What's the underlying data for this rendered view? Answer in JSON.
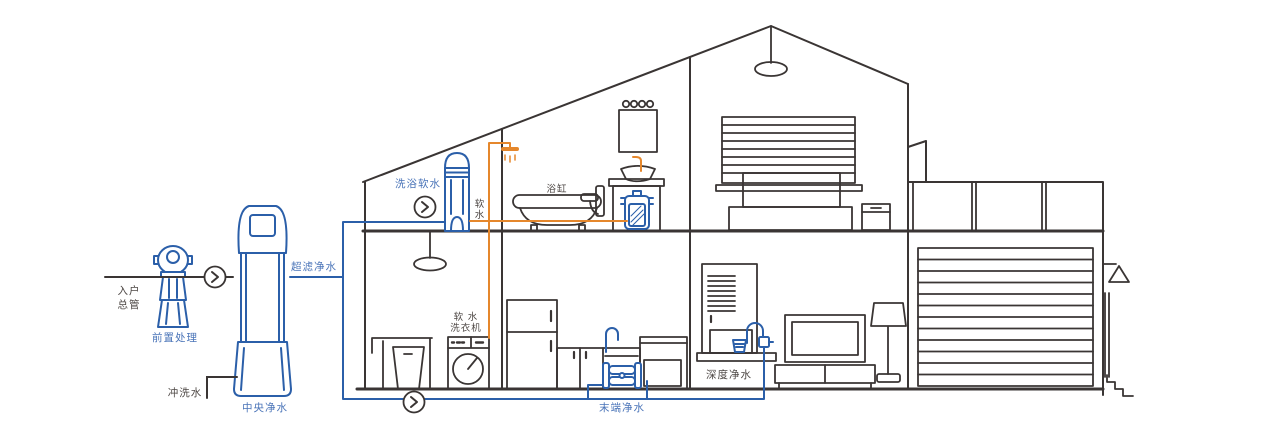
{
  "diagram": {
    "type": "whole-house-water-system-cutaway",
    "colors": {
      "background": "#FFFFFF",
      "outline_dark": "#3A3534",
      "pipe_blue": "#2B5FA9",
      "pipe_orange": "#E5872C",
      "label_blue": "#4A74B8",
      "label_dark": "#4D4744"
    },
    "labels": {
      "entry_main_line1": "入户",
      "entry_main_line2": "总管",
      "pre_treatment": "前置处理",
      "flush_water": "冲洗水",
      "central_purification": "中央净水",
      "ultrafiltration_water": "超滤净水",
      "bath_soft_water": "洗浴软水",
      "soft_water_vert_line1": "软",
      "soft_water_vert_line2": "水",
      "bathtub": "浴缸",
      "soft_water_washer_line1": "软 水",
      "soft_water_washer_line2": "洗衣机",
      "terminal_purification": "末端净水",
      "deep_purification": "深度净水"
    }
  }
}
